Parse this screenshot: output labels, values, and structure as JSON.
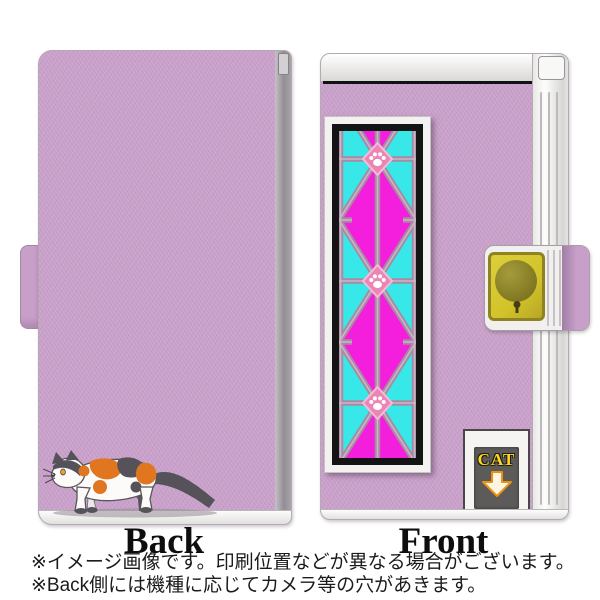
{
  "views": {
    "back": {
      "label": "Back",
      "illustration": "calico-cat-walking-left"
    },
    "front": {
      "label": "Front",
      "cat_door": {
        "label": "CAT",
        "icon": "down-arrow-icon"
      },
      "decor_strip": "stained-glass-lattice-with-paw-prints",
      "clasp": "magnetic-clasp-yellow-plate"
    }
  },
  "notes": [
    "※イメージ画像です。印刷位置などが異なる場合がございます。",
    "※Back側には機種に応じてカメラ等の穴があきます。"
  ],
  "palette": {
    "case_lavender": "#c89fc9",
    "magenta": "#f41fdc",
    "cyan": "#38e7e7",
    "lattice_mauve": "#a78ba3",
    "paw_pink": "#ec84b4",
    "clasp_yellow": "#d3c32b",
    "clasp_border": "#8f8222",
    "door_gray": "#5d5b59",
    "cat_label_yellow": "#ffd714",
    "arrow_orange": "#e8920f",
    "cat_orange": "#e0761f",
    "cat_dark": "#55525a"
  }
}
